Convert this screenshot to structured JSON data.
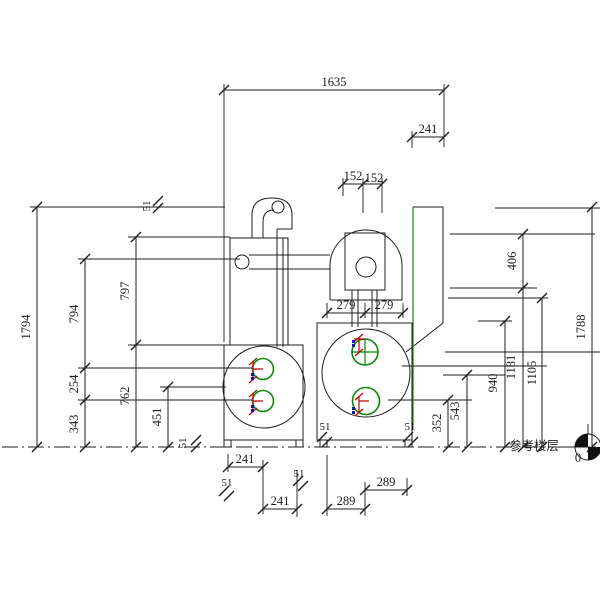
{
  "drawing": {
    "colors": {
      "line": "#1c1c1c",
      "feature_green": "#0a870a",
      "mark_red": "#c40000",
      "mark_blue": "#1414b4",
      "background": "#ffffff"
    },
    "dims": {
      "overall_width": "1635",
      "offset_top_right": "241",
      "hopper_half_left": "152",
      "hopper_half_right": "152",
      "pump_half_left": "279",
      "pump_half_right": "279",
      "height_overall_left": "1794",
      "height_body_top": "797",
      "height_pipe_center": "794",
      "port_spacing": "254",
      "height_body_bottom": "762",
      "height_port_bottom": "343",
      "height_drum_center": "451",
      "height_inner_top": "406",
      "height_overall_right": "1788",
      "height_inner_bottom": "1181",
      "height_dome_base": "1105",
      "height_tank_top": "940",
      "height_tank_center": "543",
      "height_port_center": "352",
      "base_left_a": "241",
      "base_left_b": "241",
      "base_right_a": "289",
      "base_right_b": "289",
      "gap_top_left": "51",
      "gap_base_left": "51",
      "foot_chain_left_a": "51",
      "foot_chain_left_b": "51",
      "foot_right_unit_left": "51",
      "foot_right_unit_right": "51"
    },
    "datum": {
      "label": "参考楼层",
      "value": "0"
    }
  }
}
